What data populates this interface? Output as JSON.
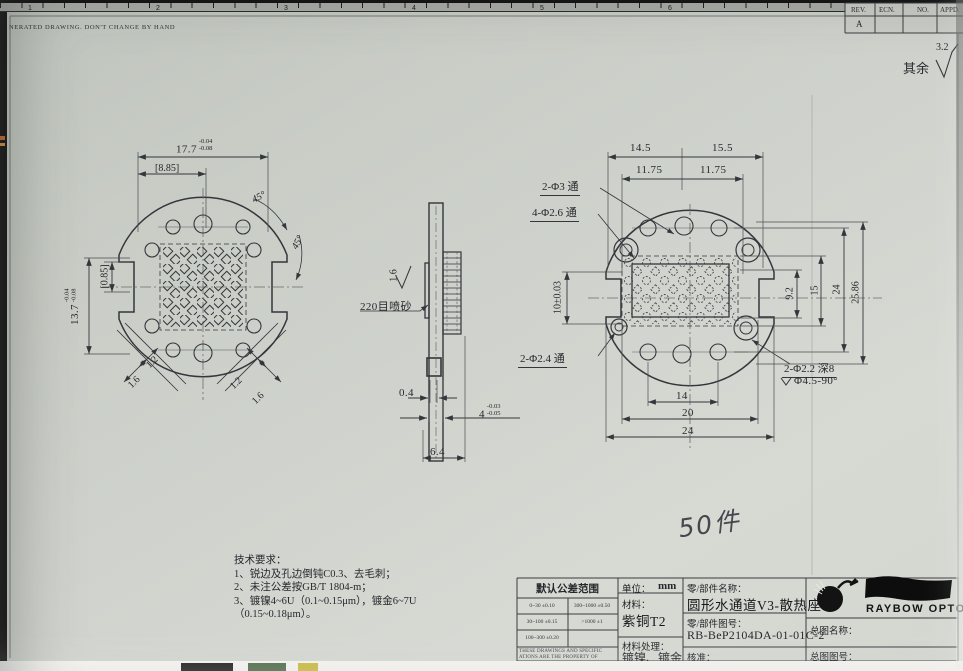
{
  "page": {
    "top_note": "NERATED DRAWING. DON'T CHANGE BY HAND",
    "ruler_numbers": [
      "1",
      "2",
      "3",
      "4",
      "5",
      "6"
    ],
    "handwriting": "50件",
    "film_strip_colors": [
      "#1d1d1f",
      "#4e6b4a",
      "#c9b93e"
    ]
  },
  "rev_table": {
    "headers": [
      "REV.",
      "ECN.",
      "NO.",
      "APPD."
    ],
    "rev_value": "A"
  },
  "surface_finish": {
    "prefix": "其余",
    "value": "3.2"
  },
  "front_view": {
    "dim_width": "17.7",
    "dim_width_tol_up": "-0.04",
    "dim_width_tol_dn": "-0.08",
    "dim_ref_width": "[8.85]",
    "angle_a": "45°",
    "angle_b": "45°",
    "dim_height": "13.7",
    "dim_height_tol_up": "-0.04",
    "dim_height_tol_dn": "-0.08",
    "dim_ref_offset": "[0.85]",
    "slot_dims": [
      "1.2",
      "1.6",
      "1.2",
      "1.6"
    ]
  },
  "side_view": {
    "roughness": "1.6",
    "blast_note": "220目喷砂",
    "dim_fin_pitch": "0.4",
    "dim_thickness": "4",
    "dim_thickness_tol_up": "-0.03",
    "dim_thickness_tol_dn": "-0.05",
    "dim_total": "6.4"
  },
  "back_view": {
    "dim_top_left": "14.5",
    "dim_top_right": "15.5",
    "dim_mid_left": "11.75",
    "dim_mid_right": "11.75",
    "label_top_holes": "2-Φ3 通",
    "label_corner_holes": "4-Φ2.6 通",
    "dim_pocket": "10±0.03",
    "dim_r1": "9.2",
    "dim_r2": "15",
    "dim_r3": "24",
    "dim_r4": "25.86",
    "label_side_holes": "2-Φ2.4 通",
    "label_cbore": "2-Φ2.2 深8",
    "label_csink": "Φ4.5-90°",
    "dim_b1": "14",
    "dim_b2": "20",
    "dim_b3": "24"
  },
  "tech_req": {
    "title": "技术要求：",
    "line1": "1、锐边及孔边倒钝C0.3、去毛刺；",
    "line2": "2、未注公差按GB/T 1804-m；",
    "line3": "3、镀镍4~6U（0.1~0.15μm），镀金6~7U",
    "line4": "（0.15~0.18μm）。"
  },
  "title_block": {
    "tol_header": "默认公差范围",
    "tol_cells": [
      [
        "0~30  ±0.10",
        "300~1000  ±0.50"
      ],
      [
        "30~100  ±0.15",
        ">1000  ±1"
      ],
      [
        "100~300  ±0.20",
        ""
      ]
    ],
    "property_note_1": "THESE DRAWINGS AND SPECIFIC",
    "property_note_2": "ATIONS ARE THE PROPERTY OF",
    "unit_label": "单位：",
    "unit_value": "mm",
    "material_label": "材料：",
    "material_value": "紫铜T2",
    "finish_label": "材料处理：",
    "finish_value": "镀镍、镀金",
    "part_name_label": "零/部件名称：",
    "part_name_value": "圆形水通道V3-散热座",
    "part_no_label": "零/部件图号：",
    "part_no_value": "RB-BeP2104DA-01-01C-2",
    "approval_label": "核准：",
    "brand": "RAYBOW OPTO",
    "assembly_name_label": "总图名称：",
    "assembly_no_label": "总图图号："
  }
}
